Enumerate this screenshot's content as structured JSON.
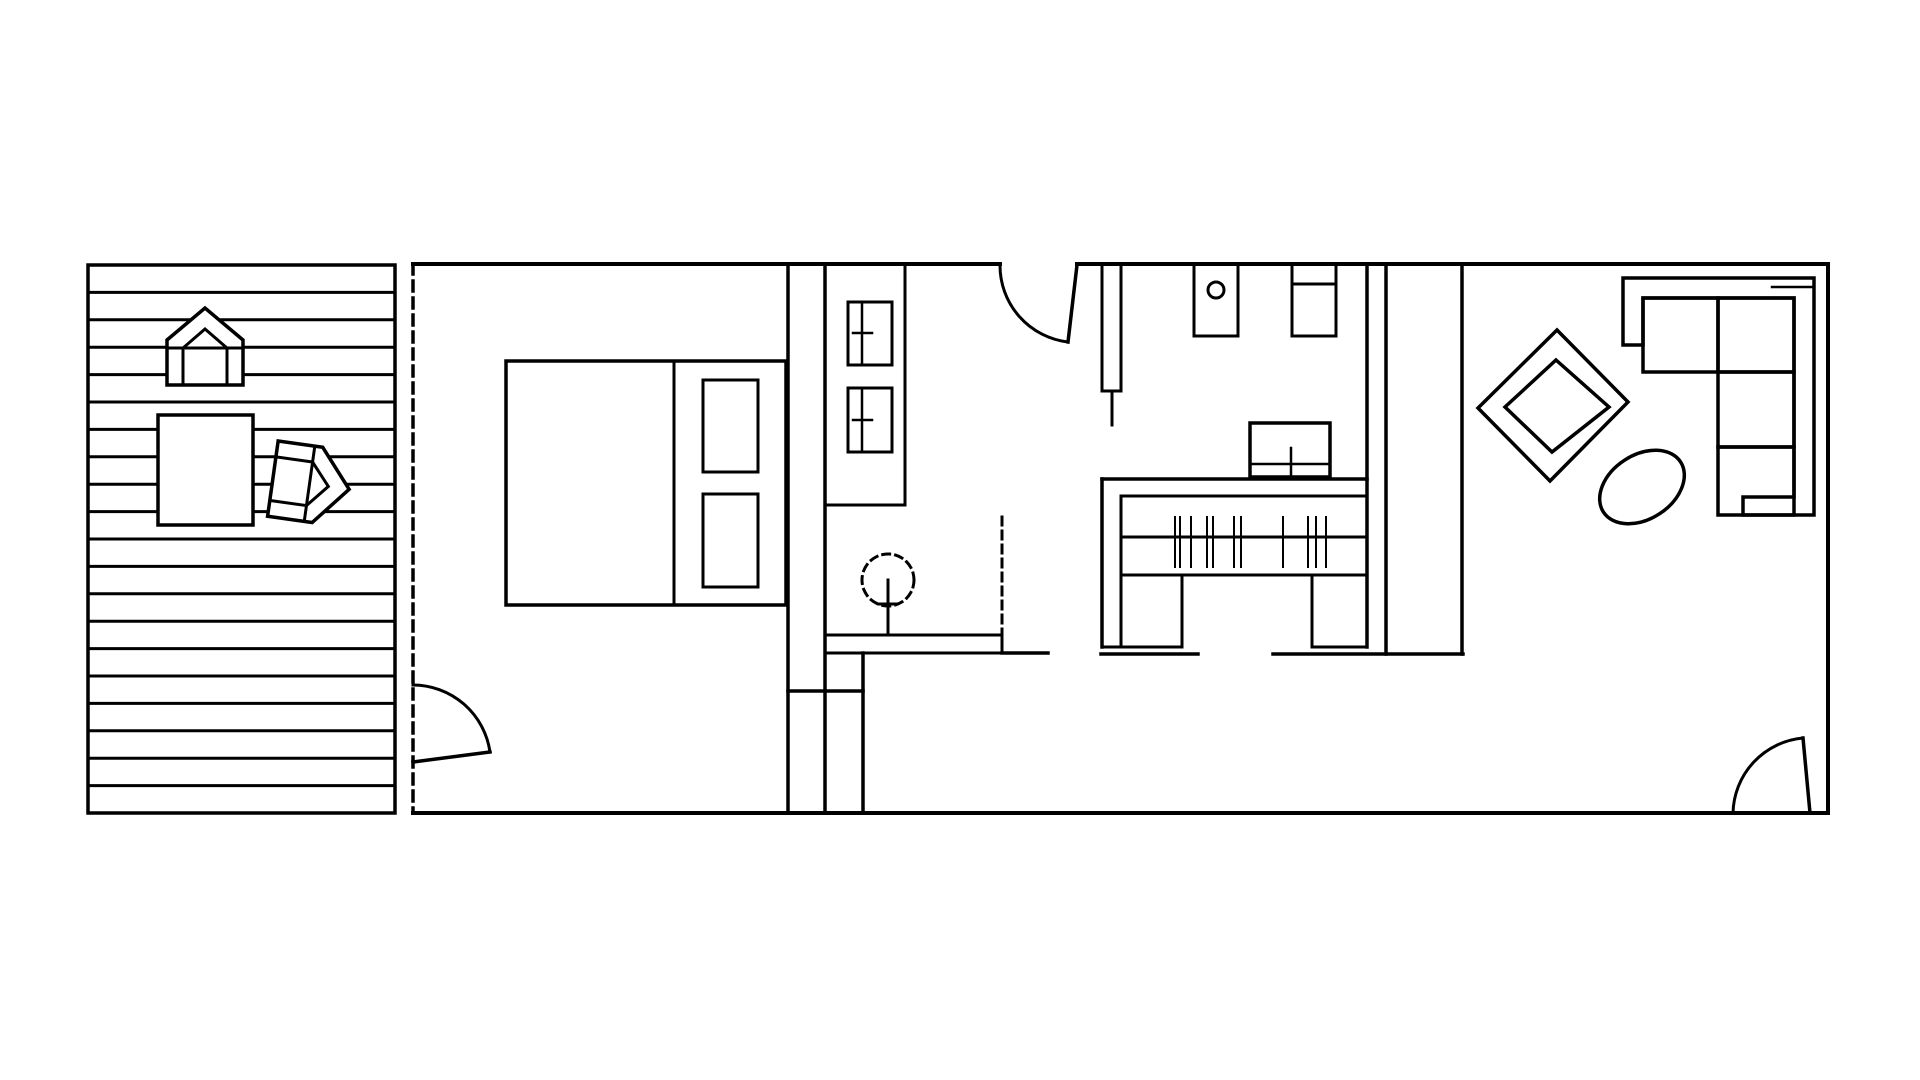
{
  "meta": {
    "canvas_width": 1920,
    "canvas_height": 1080,
    "background_color": "#ffffff",
    "line_color": "#000000",
    "drawing_type": "floor-plan"
  },
  "floorplan": {
    "elements": [
      {
        "t": "rect",
        "n": "deck-outline",
        "x": 88,
        "y": 265,
        "w": 307,
        "h": 548,
        "sw": 3.5
      },
      {
        "t": "planks",
        "n": "deck-plank-lines",
        "x1": 88,
        "x2": 395,
        "y0": 265,
        "y1": 813,
        "count": 19,
        "sw": 3
      },
      {
        "t": "path",
        "n": "deck-chair-top-outline",
        "d": "M167,385 L167,340 L205,308 L243,340 L243,385 Z",
        "f": "#ffffff",
        "sw": 3.5
      },
      {
        "t": "line",
        "n": "deck-chair-top-seat",
        "x1": 167,
        "y1": 348,
        "x2": 243,
        "y2": 348,
        "sw": 3
      },
      {
        "t": "path",
        "n": "deck-chair-top-inner",
        "d": "M183,385 L183,348 L205,329 L227,348 L227,385",
        "sw": 3
      },
      {
        "t": "rect",
        "n": "deck-table",
        "x": 158,
        "y": 415,
        "w": 95,
        "h": 110,
        "f": "#ffffff",
        "sw": 3.5
      },
      {
        "t": "group",
        "n": "deck-chair-side",
        "tx": 311,
        "ty": 484,
        "rot": 98,
        "children": [
          {
            "t": "path",
            "n": "deck-chair-side-outline",
            "d": "M-38,38.5 L-38,-6.5 L0,-38.5 L38,-6.5 L38,38.5 Z",
            "f": "#ffffff",
            "sw": 3.5
          },
          {
            "t": "path",
            "n": "deck-chair-side-seat",
            "d": "M-38,1.5 L38,1.5",
            "sw": 3
          },
          {
            "t": "path",
            "n": "deck-chair-side-inner",
            "d": "M-22,38.5 L-22,1.5 L0,-17.5 L22,1.5 L22,38.5",
            "sw": 3
          }
        ]
      },
      {
        "t": "line",
        "n": "wall-top-left-segment",
        "x1": 413,
        "y1": 264,
        "x2": 1000,
        "y2": 264,
        "sw": 4
      },
      {
        "t": "line",
        "n": "wall-top-right-segment",
        "x1": 1077,
        "y1": 264,
        "x2": 1828,
        "y2": 264,
        "sw": 4
      },
      {
        "t": "line",
        "n": "wall-right",
        "x1": 1828,
        "y1": 264,
        "x2": 1828,
        "y2": 813,
        "sw": 4
      },
      {
        "t": "line",
        "n": "wall-bottom",
        "x1": 413,
        "y1": 813,
        "x2": 1828,
        "y2": 813,
        "sw": 4
      },
      {
        "t": "line",
        "n": "glass-sliding-wall",
        "x1": 413,
        "y1": 264,
        "x2": 413,
        "y2": 813,
        "sw": 3.5,
        "dash": "10,7"
      },
      {
        "t": "line",
        "n": "wall-bedroom-east-1",
        "x1": 788,
        "y1": 264,
        "x2": 788,
        "y2": 813,
        "sw": 3.5
      },
      {
        "t": "line",
        "n": "wall-bedroom-east-2",
        "x1": 825,
        "y1": 264,
        "x2": 825,
        "y2": 813,
        "sw": 3.5
      },
      {
        "t": "line",
        "n": "wall-closet-stub",
        "x1": 863,
        "y1": 653,
        "x2": 863,
        "y2": 813,
        "sw": 3.5
      },
      {
        "t": "line",
        "n": "wall-closet-cross",
        "x1": 788,
        "y1": 691,
        "x2": 863,
        "y2": 691,
        "sw": 3.5
      },
      {
        "t": "line",
        "n": "wall-kitchen-a",
        "x1": 1367,
        "y1": 264,
        "x2": 1367,
        "y2": 647,
        "sw": 3.5
      },
      {
        "t": "line",
        "n": "wall-kitchen-b",
        "x1": 1386,
        "y1": 264,
        "x2": 1386,
        "y2": 654,
        "sw": 3.5
      },
      {
        "t": "line",
        "n": "wall-livingroom-west",
        "x1": 1462,
        "y1": 264,
        "x2": 1462,
        "y2": 654,
        "sw": 3.5
      },
      {
        "t": "line",
        "n": "wall-kitchen-close",
        "x1": 1273,
        "y1": 654,
        "x2": 1463,
        "y2": 654,
        "sw": 3.5
      },
      {
        "t": "rect",
        "n": "bath-cabinet",
        "x": 825,
        "y": 264,
        "w": 80,
        "h": 241,
        "sw": 3
      },
      {
        "t": "rect",
        "n": "bath-cabinet-door-1",
        "x": 848,
        "y": 302,
        "w": 44,
        "h": 63,
        "sw": 3
      },
      {
        "t": "line",
        "n": "bath-cabinet-door-1-divider",
        "x1": 862,
        "y1": 302,
        "x2": 862,
        "y2": 365,
        "sw": 2.5
      },
      {
        "t": "line",
        "n": "bath-cabinet-door-1-handle",
        "x1": 853,
        "y1": 333,
        "x2": 872,
        "y2": 333,
        "sw": 2.5
      },
      {
        "t": "rect",
        "n": "bath-cabinet-door-2",
        "x": 848,
        "y": 388,
        "w": 44,
        "h": 64,
        "sw": 3
      },
      {
        "t": "line",
        "n": "bath-cabinet-door-2-divider",
        "x1": 862,
        "y1": 388,
        "x2": 862,
        "y2": 452,
        "sw": 2.5
      },
      {
        "t": "line",
        "n": "bath-cabinet-door-2-handle",
        "x1": 853,
        "y1": 420,
        "x2": 872,
        "y2": 420,
        "sw": 2.5
      },
      {
        "t": "rect",
        "n": "bed-outline",
        "x": 506,
        "y": 361,
        "w": 280,
        "h": 244,
        "sw": 3.5
      },
      {
        "t": "line",
        "n": "bed-headboard-divider",
        "x1": 674,
        "y1": 361,
        "x2": 674,
        "y2": 605,
        "sw": 3
      },
      {
        "t": "rect",
        "n": "bed-pillow-1",
        "x": 703,
        "y": 380,
        "w": 55,
        "h": 92,
        "sw": 3
      },
      {
        "t": "rect",
        "n": "bed-pillow-2",
        "x": 703,
        "y": 494,
        "w": 55,
        "h": 93,
        "sw": 3
      },
      {
        "t": "rect",
        "n": "appliance-with-knob",
        "x": 1194,
        "y": 264,
        "w": 44,
        "h": 72,
        "sw": 3
      },
      {
        "t": "circle",
        "n": "appliance-knob",
        "cx": 1216,
        "cy": 290,
        "r": 8,
        "sw": 3
      },
      {
        "t": "rect",
        "n": "wall-fixture",
        "x": 1292,
        "y": 264,
        "w": 44,
        "h": 72,
        "sw": 3
      },
      {
        "t": "line",
        "n": "wall-fixture-divider",
        "x1": 1292,
        "y1": 284,
        "x2": 1336,
        "y2": 284,
        "sw": 3
      },
      {
        "t": "rect",
        "n": "tall-cabinet",
        "x": 1102,
        "y": 264,
        "w": 19,
        "h": 127,
        "sw": 3
      },
      {
        "t": "line",
        "n": "tall-cabinet-handle",
        "x1": 1112,
        "y1": 391,
        "x2": 1112,
        "y2": 425,
        "sw": 3
      },
      {
        "t": "rect",
        "n": "sink-unit",
        "x": 1250,
        "y": 423,
        "w": 80,
        "h": 54,
        "sw": 3.5
      },
      {
        "t": "line",
        "n": "sink-unit-divider",
        "x1": 1250,
        "y1": 464,
        "x2": 1330,
        "y2": 464,
        "sw": 2.5
      },
      {
        "t": "line",
        "n": "sink-unit-faucet",
        "x1": 1291,
        "y1": 448,
        "x2": 1291,
        "y2": 477,
        "sw": 2.5
      },
      {
        "t": "line",
        "n": "counter-top-outer",
        "x1": 1102,
        "y1": 479,
        "x2": 1367,
        "y2": 479,
        "sw": 3.5
      },
      {
        "t": "line",
        "n": "counter-top-inner",
        "x1": 1121,
        "y1": 496,
        "x2": 1367,
        "y2": 496,
        "sw": 3
      },
      {
        "t": "line",
        "n": "counter-left-outer",
        "x1": 1102,
        "y1": 479,
        "x2": 1102,
        "y2": 647,
        "sw": 3.5
      },
      {
        "t": "line",
        "n": "counter-left-inner",
        "x1": 1121,
        "y1": 496,
        "x2": 1121,
        "y2": 647,
        "sw": 3
      },
      {
        "t": "line",
        "n": "counter-shelf-mid",
        "x1": 1121,
        "y1": 537,
        "x2": 1367,
        "y2": 537,
        "sw": 3
      },
      {
        "t": "line",
        "n": "counter-shelf-low",
        "x1": 1121,
        "y1": 575,
        "x2": 1367,
        "y2": 575,
        "sw": 3
      },
      {
        "t": "line",
        "n": "counter-left-leg-edge",
        "x1": 1182,
        "y1": 575,
        "x2": 1182,
        "y2": 647,
        "sw": 3
      },
      {
        "t": "line",
        "n": "counter-left-leg-bottom",
        "x1": 1102,
        "y1": 647,
        "x2": 1182,
        "y2": 647,
        "sw": 3
      },
      {
        "t": "line",
        "n": "counter-right-leg-edge",
        "x1": 1312,
        "y1": 575,
        "x2": 1312,
        "y2": 647,
        "sw": 3
      },
      {
        "t": "line",
        "n": "counter-right-leg-bottom",
        "x1": 1312,
        "y1": 647,
        "x2": 1367,
        "y2": 647,
        "sw": 3
      },
      {
        "t": "line",
        "n": "counter-floor-line",
        "x1": 1101,
        "y1": 654,
        "x2": 1198,
        "y2": 654,
        "sw": 3.5
      },
      {
        "t": "bars",
        "n": "counter-slats",
        "xs": [
          1175,
          1180,
          1191,
          1207,
          1213,
          1234,
          1241,
          1283,
          1308,
          1316,
          1326
        ],
        "ya": 517,
        "yb": 567,
        "sw": 2
      },
      {
        "t": "rect",
        "n": "hall-console",
        "x": 825,
        "y": 635,
        "w": 177,
        "h": 18,
        "sw": 3
      },
      {
        "t": "line",
        "n": "hall-console-extension",
        "x1": 1002,
        "y1": 653,
        "x2": 1048,
        "y2": 653,
        "sw": 3.5
      },
      {
        "t": "circle",
        "n": "potted-plant-canopy",
        "cx": 888,
        "cy": 580,
        "r": 26,
        "sw": 3,
        "dash": "7,6"
      },
      {
        "t": "line",
        "n": "potted-plant-stem",
        "x1": 888,
        "y1": 580,
        "x2": 888,
        "y2": 634,
        "sw": 3
      },
      {
        "t": "line",
        "n": "potted-plant-branch",
        "x1": 879,
        "y1": 604,
        "x2": 897,
        "y2": 604,
        "sw": 3
      },
      {
        "t": "line",
        "n": "hall-dashed-guide",
        "x1": 1002,
        "y1": 517,
        "x2": 1002,
        "y2": 633,
        "sw": 3,
        "dash": "8,6"
      },
      {
        "t": "path",
        "n": "deck-door-swing-arc",
        "d": "M413,685 A78,78 0 0 1 490,752",
        "sw": 3
      },
      {
        "t": "line",
        "n": "deck-door-leaf",
        "x1": 413,
        "y1": 762,
        "x2": 490,
        "y2": 752,
        "sw": 3.5
      },
      {
        "t": "path",
        "n": "bath-door-swing-arc",
        "d": "M1000,265 A77,77 0 0 0 1068,342",
        "sw": 3
      },
      {
        "t": "line",
        "n": "bath-door-leaf",
        "x1": 1077,
        "y1": 265,
        "x2": 1068,
        "y2": 342,
        "sw": 3.5
      },
      {
        "t": "path",
        "n": "entry-door-swing-arc",
        "d": "M1733,813 A77,77 0 0 1 1803,738",
        "sw": 3
      },
      {
        "t": "line",
        "n": "entry-door-leaf",
        "x1": 1810,
        "y1": 813,
        "x2": 1803,
        "y2": 738,
        "sw": 3.5
      },
      {
        "t": "path",
        "n": "sofa-frame",
        "d": "M1623,278 L1814,278 L1814,515 L1743,515 L1743,497 L1794,497 L1794,298 L1643,298 L1643,345 L1623,345 Z",
        "sw": 3.5
      },
      {
        "t": "line",
        "n": "sofa-frame-notch",
        "x1": 1772,
        "y1": 287,
        "x2": 1814,
        "y2": 287,
        "sw": 2.5
      },
      {
        "t": "rect",
        "n": "sofa-cushion-1",
        "x": 1643,
        "y": 298,
        "w": 75,
        "h": 74,
        "sw": 3.5
      },
      {
        "t": "rect",
        "n": "sofa-cushion-2",
        "x": 1718,
        "y": 298,
        "w": 76,
        "h": 74,
        "sw": 3.5
      },
      {
        "t": "rect",
        "n": "sofa-cushion-3",
        "x": 1718,
        "y": 372,
        "w": 76,
        "h": 75,
        "sw": 3.5
      },
      {
        "t": "rect",
        "n": "sofa-cushion-4",
        "x": 1718,
        "y": 447,
        "w": 76,
        "h": 68,
        "sw": 3.5
      },
      {
        "t": "poly",
        "n": "diamond-table-outer",
        "pts": "1557,330 1628,402 1550,481 1478,408",
        "sw": 3.5
      },
      {
        "t": "poly",
        "n": "diamond-table-inner",
        "pts": "1556,360 1609,407 1552,452 1505,407",
        "sw": 3.5
      },
      {
        "t": "ellipse",
        "n": "oval-coffee-table",
        "cx": 1642,
        "cy": 487,
        "rx": 46,
        "ry": 32,
        "rot": -33,
        "sw": 3.5
      }
    ]
  }
}
